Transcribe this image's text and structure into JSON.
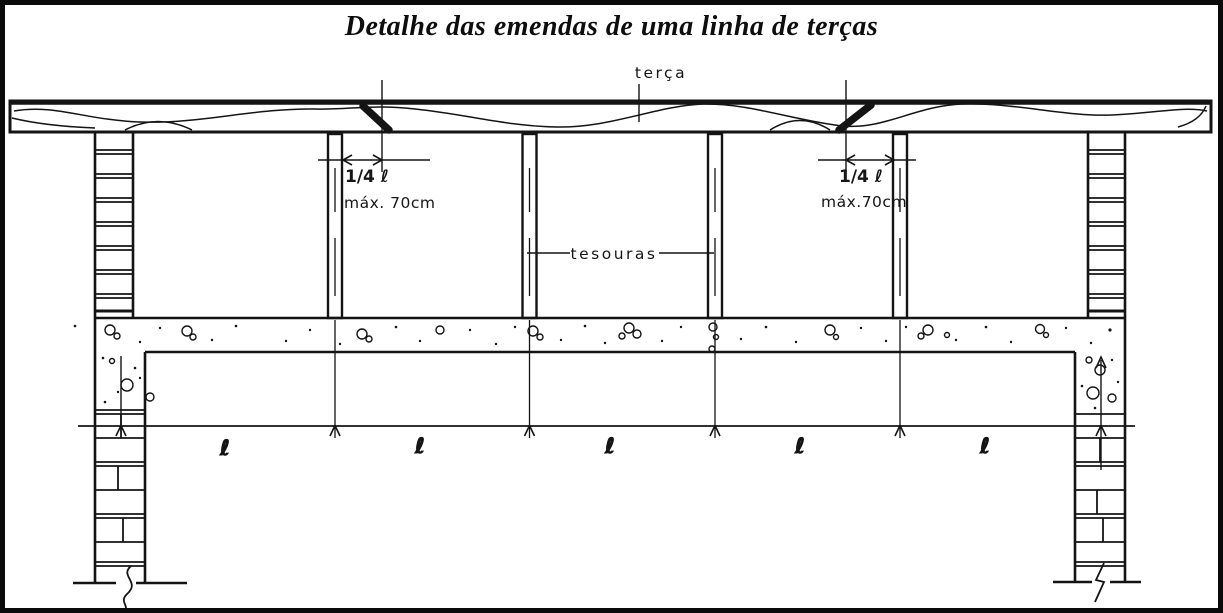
{
  "title": "Detalhe das emendas de uma linha de terças",
  "annotations": {
    "purlin_label": "terça",
    "trusses_label": "tesouras",
    "left_splice": {
      "fraction": "1/4 ℓ",
      "max_spacing": "máx. 70cm"
    },
    "right_splice": {
      "fraction": "1/4 ℓ",
      "max_spacing": "máx.70cm"
    },
    "span_labels": [
      "ℓ",
      "ℓ",
      "ℓ",
      "ℓ",
      "ℓ"
    ]
  },
  "colors": {
    "ink": "#141414",
    "paper": "#ffffff"
  }
}
